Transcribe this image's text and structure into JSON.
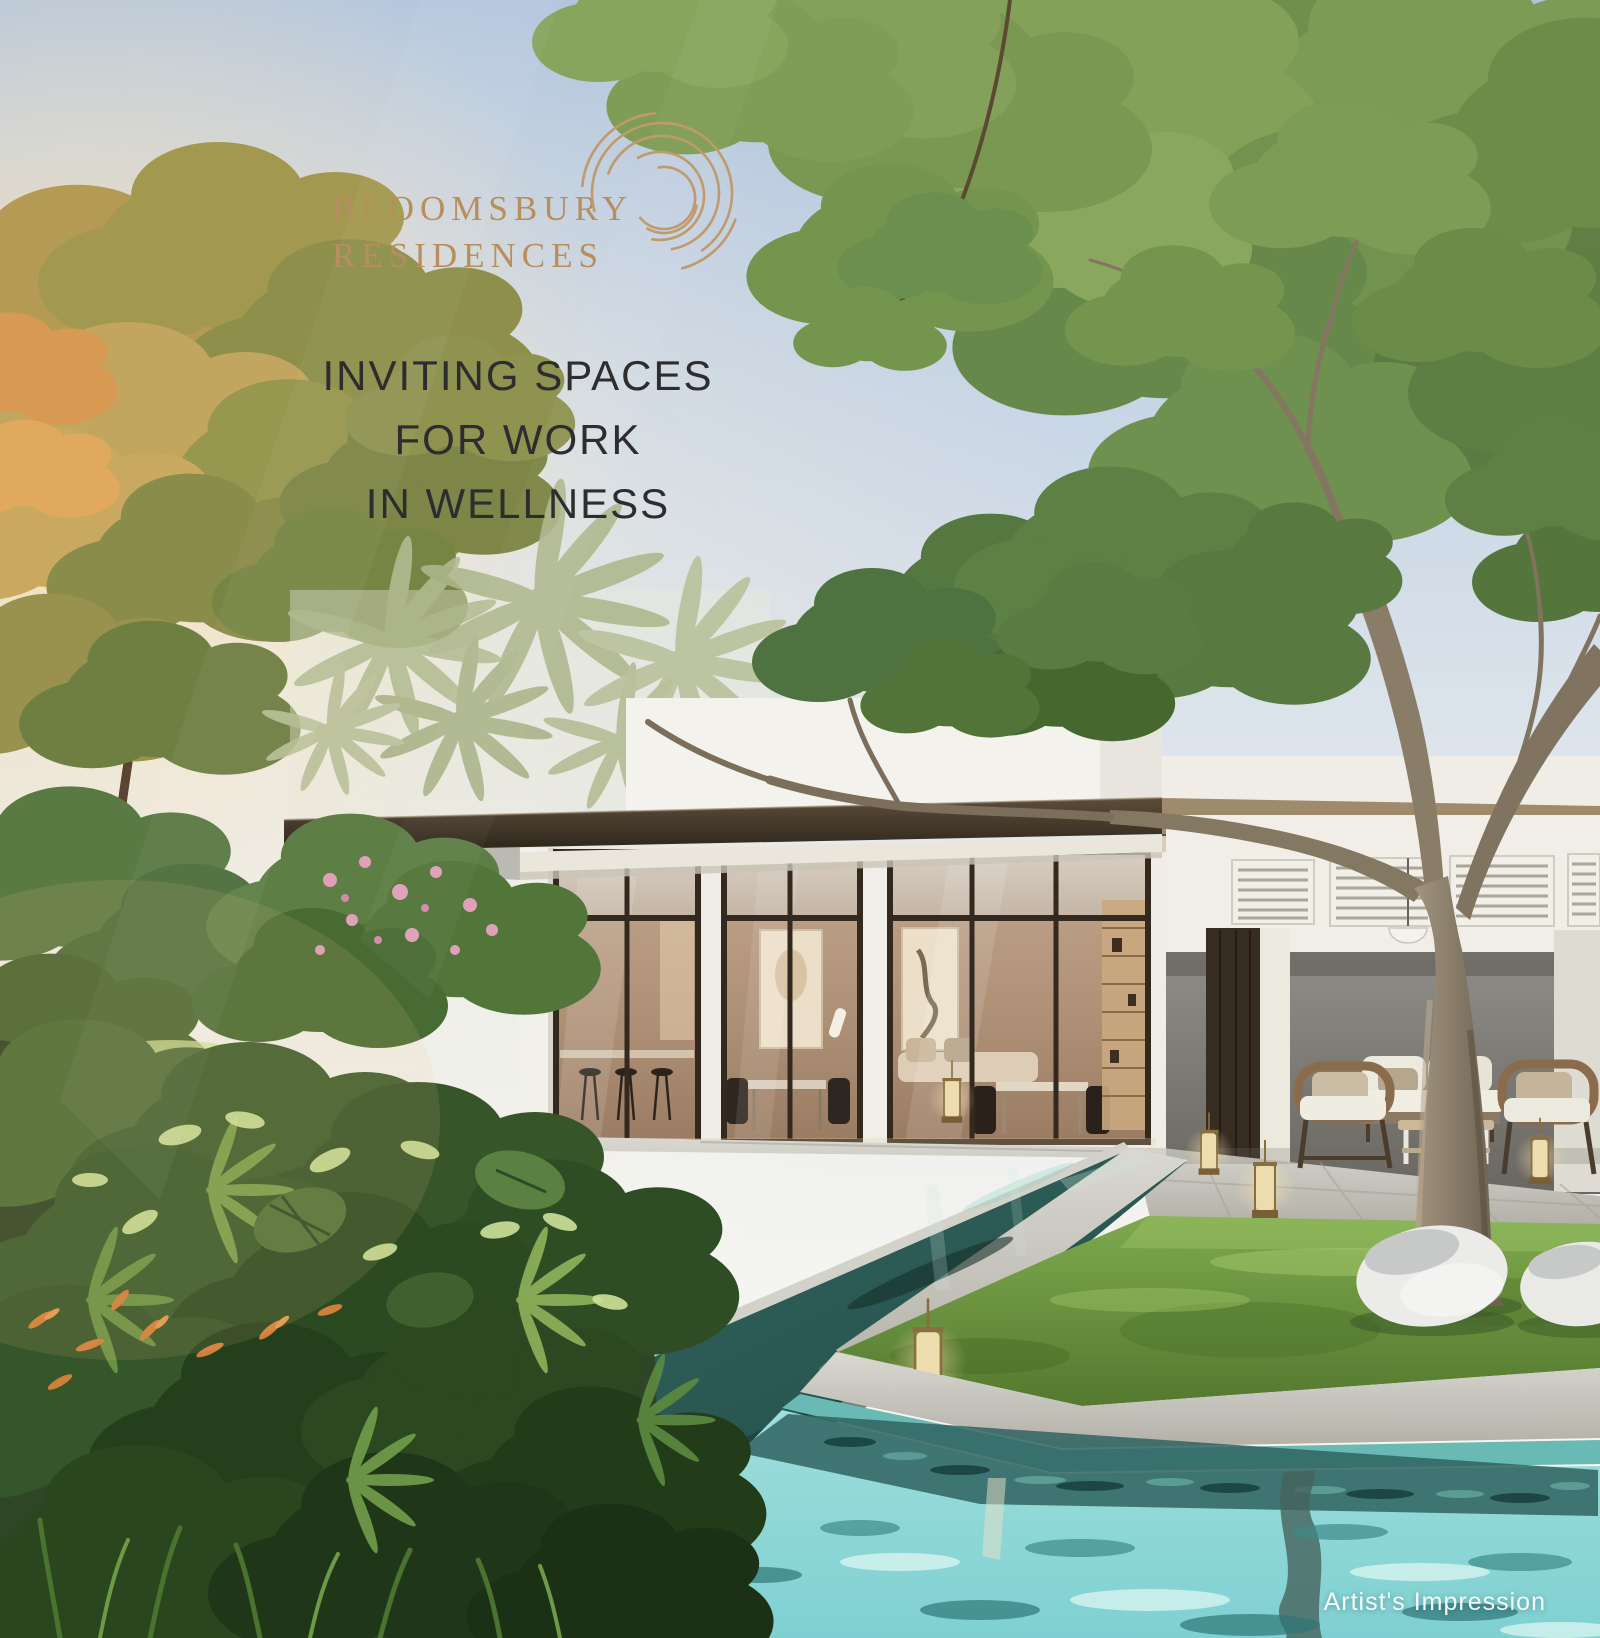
{
  "poster": {
    "brand": {
      "name_line1": "BLOOMSBURY",
      "name_line2": "RESIDENCES",
      "color": "#b78e5e"
    },
    "headline": {
      "line1": "INVITING SPACES",
      "line2": "FOR WORK",
      "line3": "IN WELLNESS",
      "color": "#2d2d30"
    },
    "caption": {
      "text": "Artist's Impression",
      "color": "#ffffff"
    },
    "scene": {
      "palette": {
        "sky_top": "#adc2de",
        "sky_horizon": "#f4f4f0",
        "sun_glow": "#f6cd8d",
        "foliage_dark": "#2e4526",
        "foliage_mid": "#557a3c",
        "foliage_light": "#8db35c",
        "lawn_green": "#6f9a45",
        "pool_shaded": "#2b5b58",
        "pool_sunlit": "#8fd8d8",
        "stone_paver": "#c9c8c0",
        "roof_bronze": "#43372a",
        "wall_white": "#f0eee7",
        "wall_gray": "#7d7a74",
        "interior_warm": "#b89a80",
        "tree_bark": "#8a7c67"
      }
    }
  }
}
